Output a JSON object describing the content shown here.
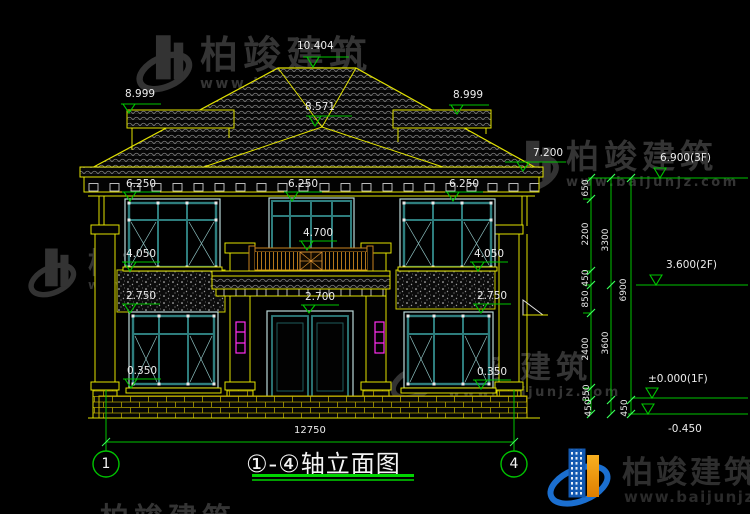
{
  "drawing": {
    "title": "①-④轴立面图",
    "total_width_dim": "12750",
    "axis_left": "1",
    "axis_right": "4",
    "levels": {
      "ridge": "10.404",
      "hip_front": "8.571",
      "side_roof_left": "8.999",
      "side_roof_right": "8.999",
      "eave_top": "7.200",
      "floor3": "6.900(3F)",
      "cornice_left": "6.250",
      "cornice_center": "6.250",
      "cornice_right": "6.250",
      "balcony": "4.700",
      "sill2_left": "4.050",
      "sill2_right": "4.050",
      "floor2": "3.600(2F)",
      "win1_top_left": "2.750",
      "win1_top_right": "2.750",
      "porch": "2.700",
      "win1_bottom_left": "0.350",
      "win1_bottom_right": "0.350",
      "floor1": "±0.000(1F)",
      "ground": "-0.450"
    },
    "vchain_inner": [
      "650",
      "2200",
      "450",
      "850",
      "2400",
      "350",
      "450"
    ],
    "vchain_middle": [
      "3300",
      "3600",
      "450"
    ],
    "vchain_outer": [
      "6900"
    ]
  },
  "watermark": {
    "brand": "柏竣建筑",
    "site": "www.baijunjz.com"
  },
  "footer_logo": {
    "brand": "柏竣建筑",
    "site": "www.baijunjz.com"
  }
}
